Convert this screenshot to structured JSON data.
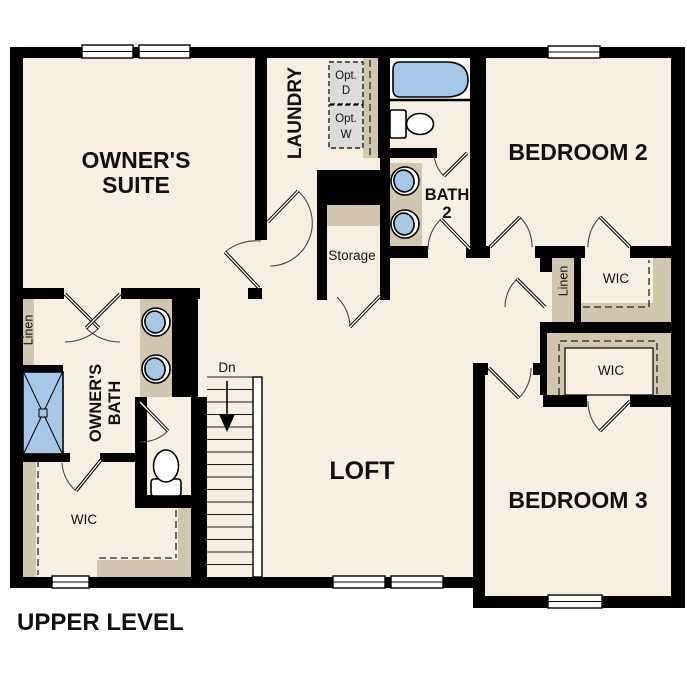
{
  "plan": {
    "title": "UPPER LEVEL",
    "rooms": {
      "owners_suite": {
        "name_line1": "OWNER'S",
        "name_line2": "SUITE"
      },
      "laundry": {
        "name": "LAUNDRY",
        "opt_dryer_line1": "Opt.",
        "opt_dryer_line2": "D",
        "opt_washer_line1": "Opt.",
        "opt_washer_line2": "W"
      },
      "bath2": {
        "name_line1": "BATH",
        "name_line2": "2"
      },
      "bedroom2": {
        "name": "BEDROOM 2",
        "wic": "WIC",
        "linen": "Linen"
      },
      "storage": {
        "name": "Storage"
      },
      "owners_bath": {
        "name_line1": "OWNER'S",
        "name_line2": "BATH",
        "linen": "Linen",
        "wic": "WIC"
      },
      "loft": {
        "name": "LOFT"
      },
      "bedroom3": {
        "name": "BEDROOM 3",
        "wic": "WIC"
      },
      "stairs": {
        "direction_label": "Dn"
      }
    },
    "fixtures": {
      "bath2": [
        "bathtub",
        "toilet",
        "double-vanity-sinks"
      ],
      "owners_bath": [
        "shower",
        "toilet",
        "double-vanity-sinks"
      ],
      "laundry": [
        "optional-dryer",
        "optional-washer"
      ],
      "stairs": "staircase-down"
    },
    "colors": {
      "wall": "#000000",
      "floor": "#f6efe2",
      "casework_tan": "#d2c7ae",
      "fixture_blue": "#a6c7e8",
      "optional_appliance_gray": "#dcdcdc",
      "window_white": "#ffffff"
    }
  }
}
